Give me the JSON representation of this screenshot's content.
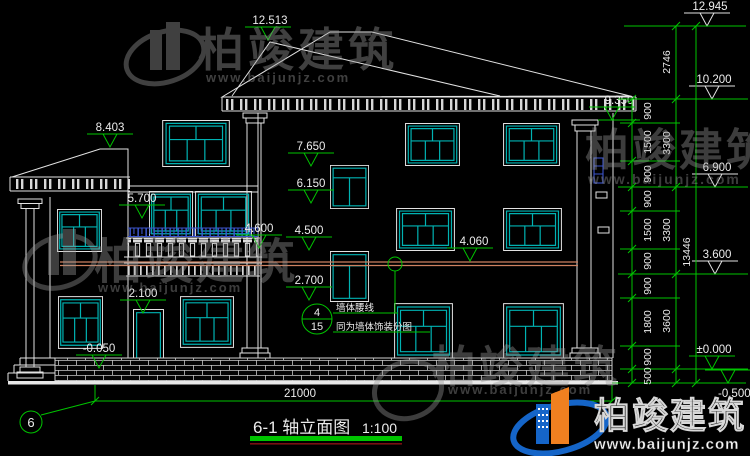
{
  "drawing": {
    "title": "6-1 轴立面图",
    "scale": "1:100",
    "axis_label": "6",
    "overall_width_dim": "21000"
  },
  "elevations": {
    "front_ridge": "12.513",
    "main_ridge": "12.945",
    "eave_top": "10.200",
    "right_eave": "9.350",
    "left_wing_ridge": "8.403",
    "stair_window_top_upper": "7.650",
    "third_floor": "6.900",
    "stair_window_sill_upper": "6.150",
    "balcony_rail": "5.700",
    "balcony_slab": "4.600",
    "stair_window_top_lower": "4.500",
    "belt_line": "4.060",
    "second_floor": "3.600",
    "stair_window_sill_lower": "2.700",
    "door_top": "2.100",
    "ground_floor": "±0.000",
    "outdoor_ground": "-0.050",
    "base_bottom": "-0.500"
  },
  "dims": {
    "inner_chain": [
      "900",
      "1500",
      "900",
      "900",
      "1500",
      "900",
      "900",
      "1800",
      "900",
      "500"
    ],
    "middle_chain": [
      "2746",
      "3300",
      "3300",
      "3600"
    ],
    "total_height": "13446"
  },
  "callout": {
    "detail_number": "4",
    "sheet_number": "15",
    "note_line1": "墙体腰线",
    "note_line2": "同为墙体饰装分图"
  },
  "watermark": {
    "brand": "柏竣建筑",
    "url": "www.baijunjz.com"
  },
  "colors": {
    "background": "#000000",
    "line_white": "#e2e2e2",
    "dimension_green": "#00c400",
    "window_teal": "#00b2b2",
    "belt_orange": "#cd8160",
    "railing_blue": "#3c55cc",
    "watermark_gray": "#9a9a9a",
    "logo_blue": "#1565c8",
    "logo_orange": "#f08020",
    "title_rule_red": "#7a1010"
  }
}
